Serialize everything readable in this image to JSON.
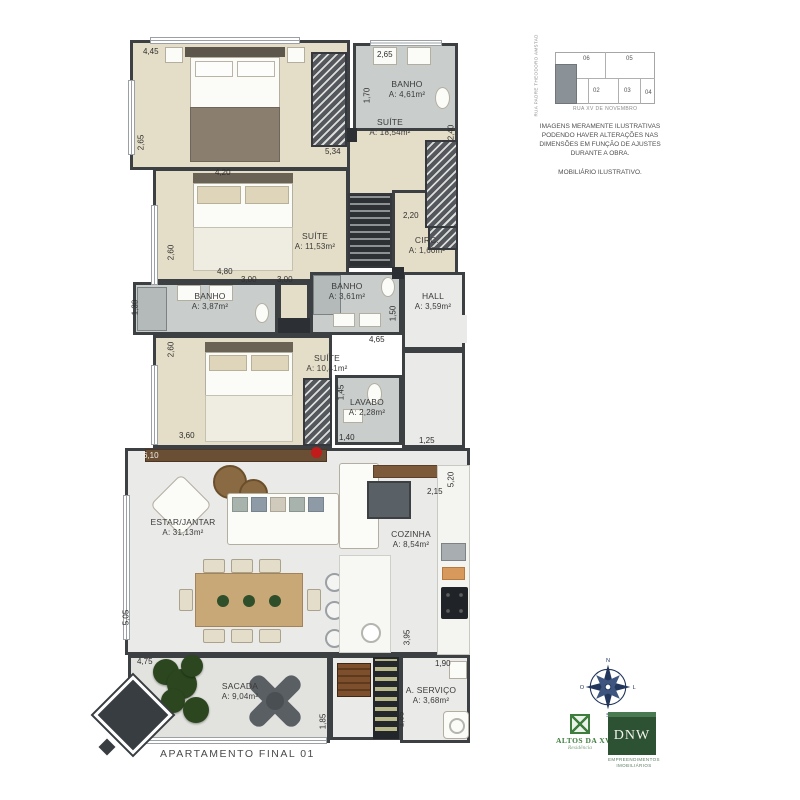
{
  "plan": {
    "title": "APARTAMENTO FINAL 01",
    "rooms": {
      "suite1": {
        "name": "SUÍTE",
        "area": "A: 18,54m²"
      },
      "banho1": {
        "name": "BANHO",
        "area": "A: 4,61m²"
      },
      "suite2": {
        "name": "SUÍTE",
        "area": "A: 11,53m²"
      },
      "circ": {
        "name": "CIRC.",
        "area": "A: 1,60m²"
      },
      "banho3": {
        "name": "BANHO",
        "area": "A: 3,87m²"
      },
      "banho2": {
        "name": "BANHO",
        "area": "A: 3,61m²"
      },
      "hall": {
        "name": "HALL",
        "area": "A: 3,59m²"
      },
      "suite3": {
        "name": "SUÍTE",
        "area": "A: 10,41m²"
      },
      "lavabo": {
        "name": "LAVABO",
        "area": "A: 2,28m²"
      },
      "estar": {
        "name": "ESTAR/JANTAR",
        "area": "A: 31,13m²"
      },
      "cozinha": {
        "name": "COZINHA",
        "area": "A: 8,54m²"
      },
      "sacada": {
        "name": "SACADA",
        "area": "A: 9,04m²"
      },
      "servico": {
        "name": "A. SERVIÇO",
        "area": "A: 3,68m²"
      }
    },
    "dims": [
      "4,45",
      "2,65",
      "1,70",
      "2,40",
      "2,65",
      "5,34",
      "4,20",
      "2,20",
      "2,60",
      "4,80",
      "3,00",
      "3,00",
      "1,30",
      "1,50",
      "4,65",
      "2,60",
      "1,45",
      "3,60",
      "1,40",
      "1,25",
      "6,10",
      "5,20",
      "2,15",
      "5,05",
      "4,75",
      "3,95",
      "1,90",
      "1,85",
      "1,85"
    ]
  },
  "keyplan": {
    "units": [
      "06",
      "05",
      "02",
      "03",
      "04"
    ],
    "street_left": "RUA PADRE THEODORO AMSTAD",
    "street_bottom": "RUA XV DE NOVEMBRO"
  },
  "disclaimer": {
    "line1": "IMAGENS MERAMENTE ILUSTRATIVAS PODENDO HAVER ALTERAÇÕES NAS DIMENSÕES EM FUNÇÃO DE AJUSTES DURANTE A OBRA.",
    "line2": "MOBILIÁRIO ILUSTRATIVO."
  },
  "compass": {
    "n": "N",
    "e": "L",
    "s": "S",
    "w": "O"
  },
  "logos": {
    "altos": {
      "name": "ALTOS DA XV",
      "sub": "Residência"
    },
    "dnw": {
      "name": "DNW",
      "sub": "EMPREENDIMENTOS IMOBILIÁRIOS"
    }
  },
  "colors": {
    "wall": "#3c4043",
    "bedroom_floor": "#e4ddc7",
    "bath_floor": "#c9cdcc",
    "living_floor": "#eaeae8",
    "accent_green": "#3f7d3f",
    "dnw_green": "#2c5233",
    "compass_navy": "#23365c",
    "flower_red": "#c11b1b"
  }
}
